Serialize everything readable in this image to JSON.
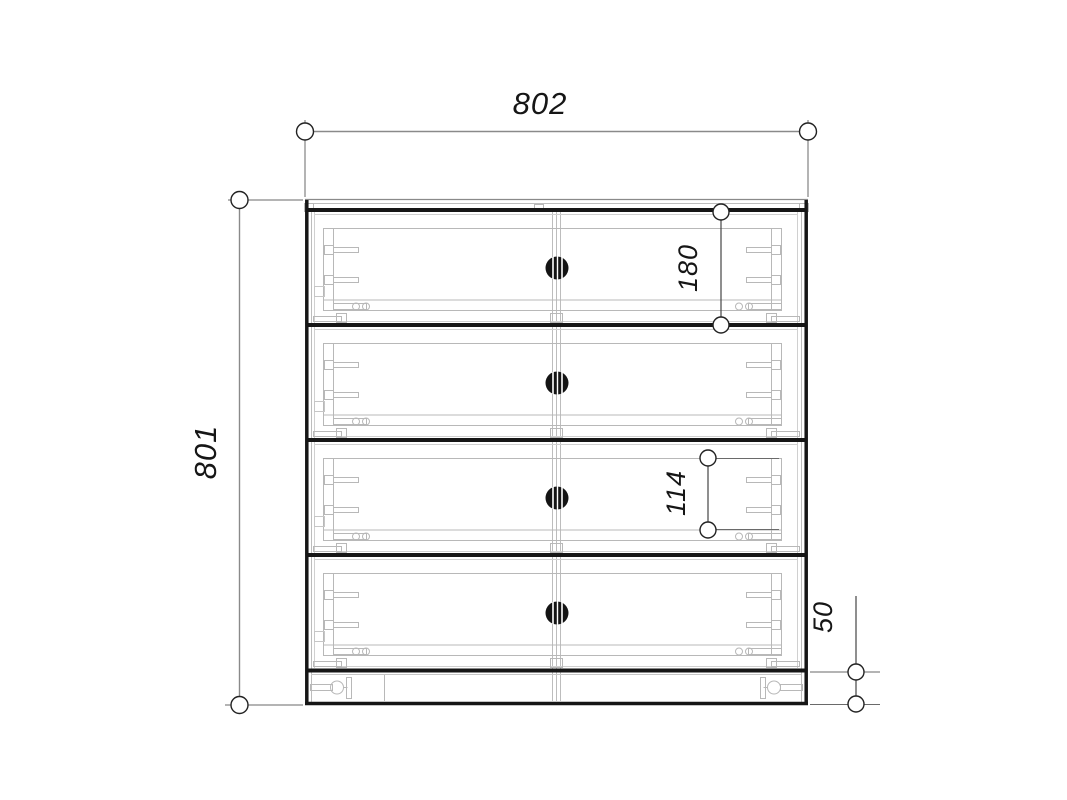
{
  "drawing": {
    "subject": "chest-of-drawers-front-view",
    "drawer_count": 4,
    "background_color": "#ffffff",
    "outline_color": "#161616",
    "detail_color": "#b8b8b8",
    "dimension_line_color": "#8a8a8a"
  },
  "dimensions": {
    "overall_width": {
      "value": "802",
      "orientation": "horizontal",
      "position": "top"
    },
    "overall_height": {
      "value": "801",
      "orientation": "vertical",
      "position": "left"
    },
    "drawer_front_height": {
      "value": "180",
      "orientation": "vertical",
      "position": "first-drawer"
    },
    "drawer_box_height": {
      "value": "114",
      "orientation": "vertical",
      "position": "third-drawer"
    },
    "plinth_height": {
      "value": "50",
      "orientation": "vertical",
      "position": "bottom-right"
    }
  }
}
